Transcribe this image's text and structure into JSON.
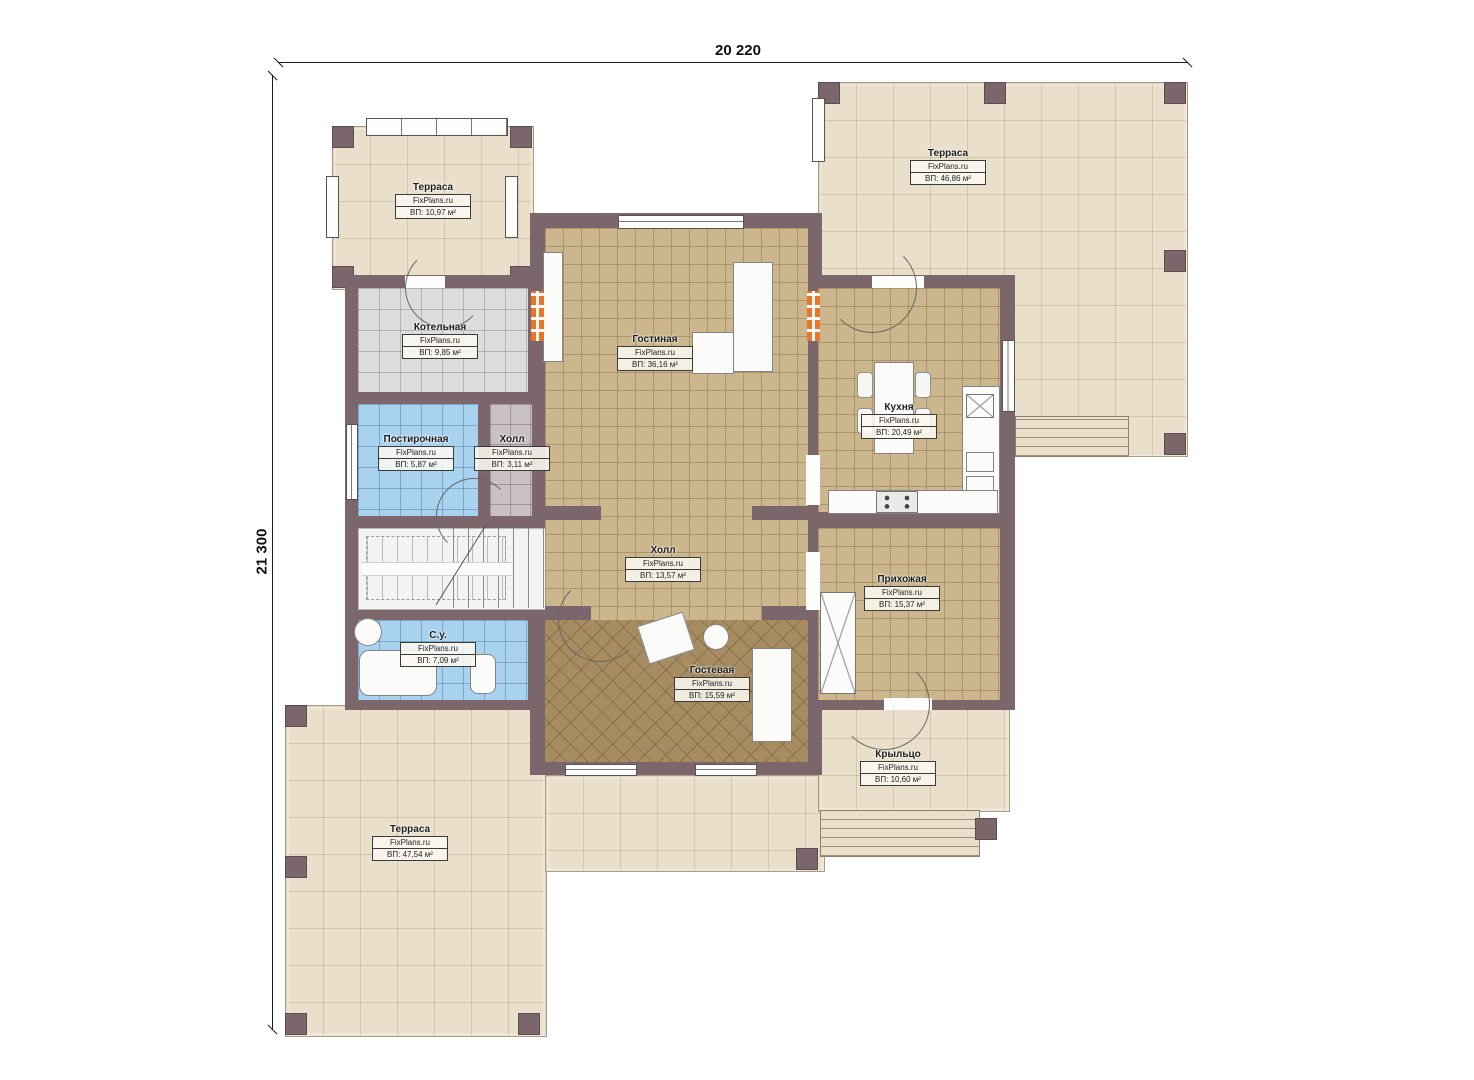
{
  "plan_title": "Floor plan",
  "dimensions": {
    "top": "20 220",
    "left": "21 300"
  },
  "branding": "FixPlans.ru",
  "rooms": [
    {
      "id": "terrace-tl",
      "name": "Терраса",
      "site": "FixPlans.ru",
      "area": "ВП: 10,97 м²"
    },
    {
      "id": "terrace-tr",
      "name": "Терраса",
      "site": "FixPlans.ru",
      "area": "ВП: 46,86 м²"
    },
    {
      "id": "kotelnaya",
      "name": "Котельная",
      "site": "FixPlans.ru",
      "area": "ВП: 9,85 м²"
    },
    {
      "id": "postirochnaya",
      "name": "Постирочная",
      "site": "FixPlans.ru",
      "area": "ВП: 5,87 м²"
    },
    {
      "id": "hall-small",
      "name": "Холл",
      "site": "FixPlans.ru",
      "area": "ВП: 3,11 м²"
    },
    {
      "id": "livingroom",
      "name": "Гостиная",
      "site": "FixPlans.ru",
      "area": "ВП: 36,16 м²"
    },
    {
      "id": "kitchen",
      "name": "Кухня",
      "site": "FixPlans.ru",
      "area": "ВП: 20,49 м²"
    },
    {
      "id": "hall-main",
      "name": "Холл",
      "site": "FixPlans.ru",
      "area": "ВП: 13,57 м²"
    },
    {
      "id": "prihozhaya",
      "name": "Прихожая",
      "site": "FixPlans.ru",
      "area": "ВП: 15,37 м²"
    },
    {
      "id": "su",
      "name": "С.у.",
      "site": "FixPlans.ru",
      "area": "ВП: 7,09 м²"
    },
    {
      "id": "gostevaya",
      "name": "Гостевая",
      "site": "FixPlans.ru",
      "area": "ВП: 15,59 м²"
    },
    {
      "id": "kryltso",
      "name": "Крыльцо",
      "site": "FixPlans.ru",
      "area": "ВП: 10,60 м²"
    },
    {
      "id": "terrace-bl",
      "name": "Терраса",
      "site": "FixPlans.ru",
      "area": "ВП: 47,54 м²"
    }
  ],
  "colors": {
    "wall": "#7a666b",
    "terrace_floor": "#e9dfcb",
    "tile_tan": "#ccb68e",
    "tile_gray": "#dcdcdc",
    "tile_blue": "#a9d2ee",
    "tile_guest": "#a68c60",
    "radiator_accent": "#e8762a"
  }
}
